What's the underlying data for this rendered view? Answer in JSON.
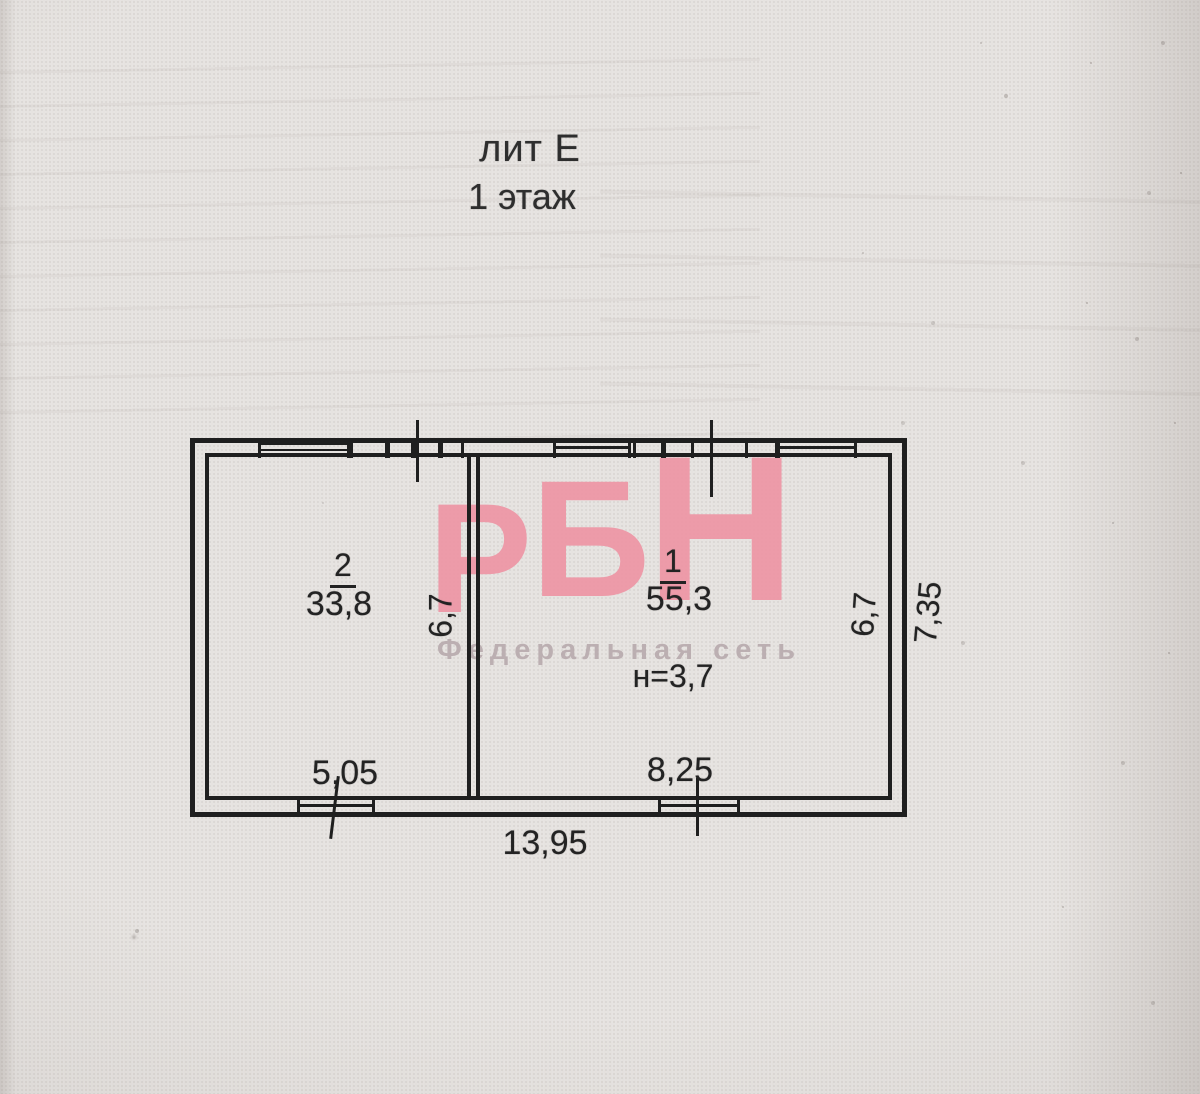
{
  "page": {
    "background_color": "#e6e3e0",
    "ink_color": "#1f1f1f"
  },
  "title": {
    "liter": "лит Е",
    "floor": "1 этаж"
  },
  "watermark": {
    "letters": [
      "Р",
      "Б",
      "Н"
    ],
    "tagline": "Федеральная сеть",
    "logo_color": "#ee95a5",
    "tagline_color": "#b5a7aa"
  },
  "floor_plan": {
    "rooms": [
      {
        "number": "2",
        "area": "33,8"
      },
      {
        "number": "1",
        "area": "55,3",
        "ceiling_height": "н=3,7"
      }
    ],
    "dimensions": {
      "room2_width_m": "5,05",
      "room1_width_m": "8,25",
      "total_width_m": "13,95",
      "room2_depth_m": "6,7",
      "room1_depth_m": "6,7",
      "exterior_depth_m": "7,35"
    }
  }
}
